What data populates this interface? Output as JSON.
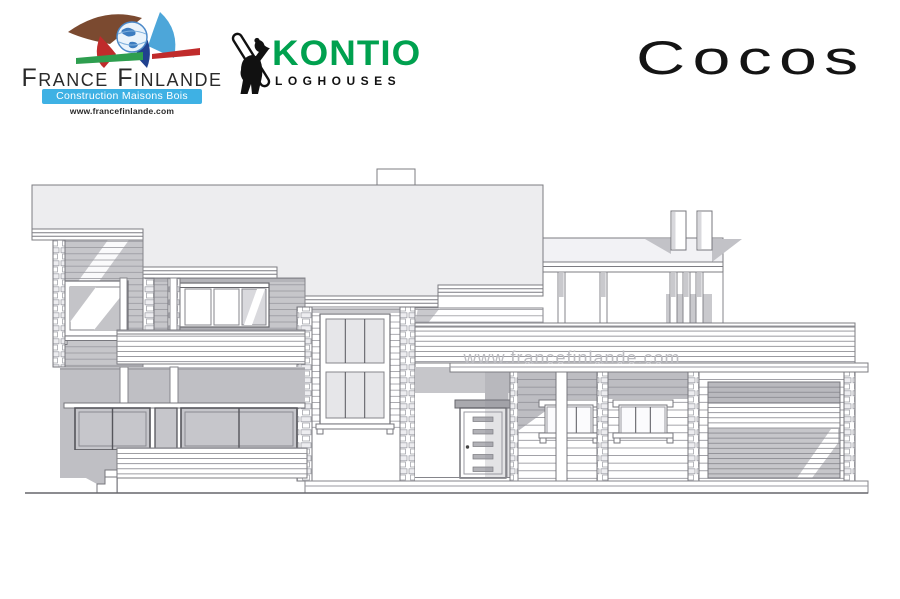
{
  "header": {
    "france_finlande": {
      "name": "France Finlande",
      "tagline": "Construction Maisons Bois",
      "url": "www.francefinlande.com"
    },
    "kontio": {
      "name": "KONTIO",
      "subtitle": "LOGHOUSES"
    },
    "model_title": "Cocos"
  },
  "drawing": {
    "watermark": "www.francefinlande.com"
  },
  "colors": {
    "kontio_green": "#00a14f",
    "banner_blue": "#3eb1e4",
    "sail_brown": "#7b4a30",
    "sail_light_blue": "#4da6d9",
    "sail_red": "#c02b2b",
    "sail_dark_blue": "#21418f",
    "band_green": "#2e9e4f",
    "watermark_gray": "#bcbcc1",
    "roof_gray": "#ededef",
    "shadow_gray": "#c6c6ca"
  }
}
